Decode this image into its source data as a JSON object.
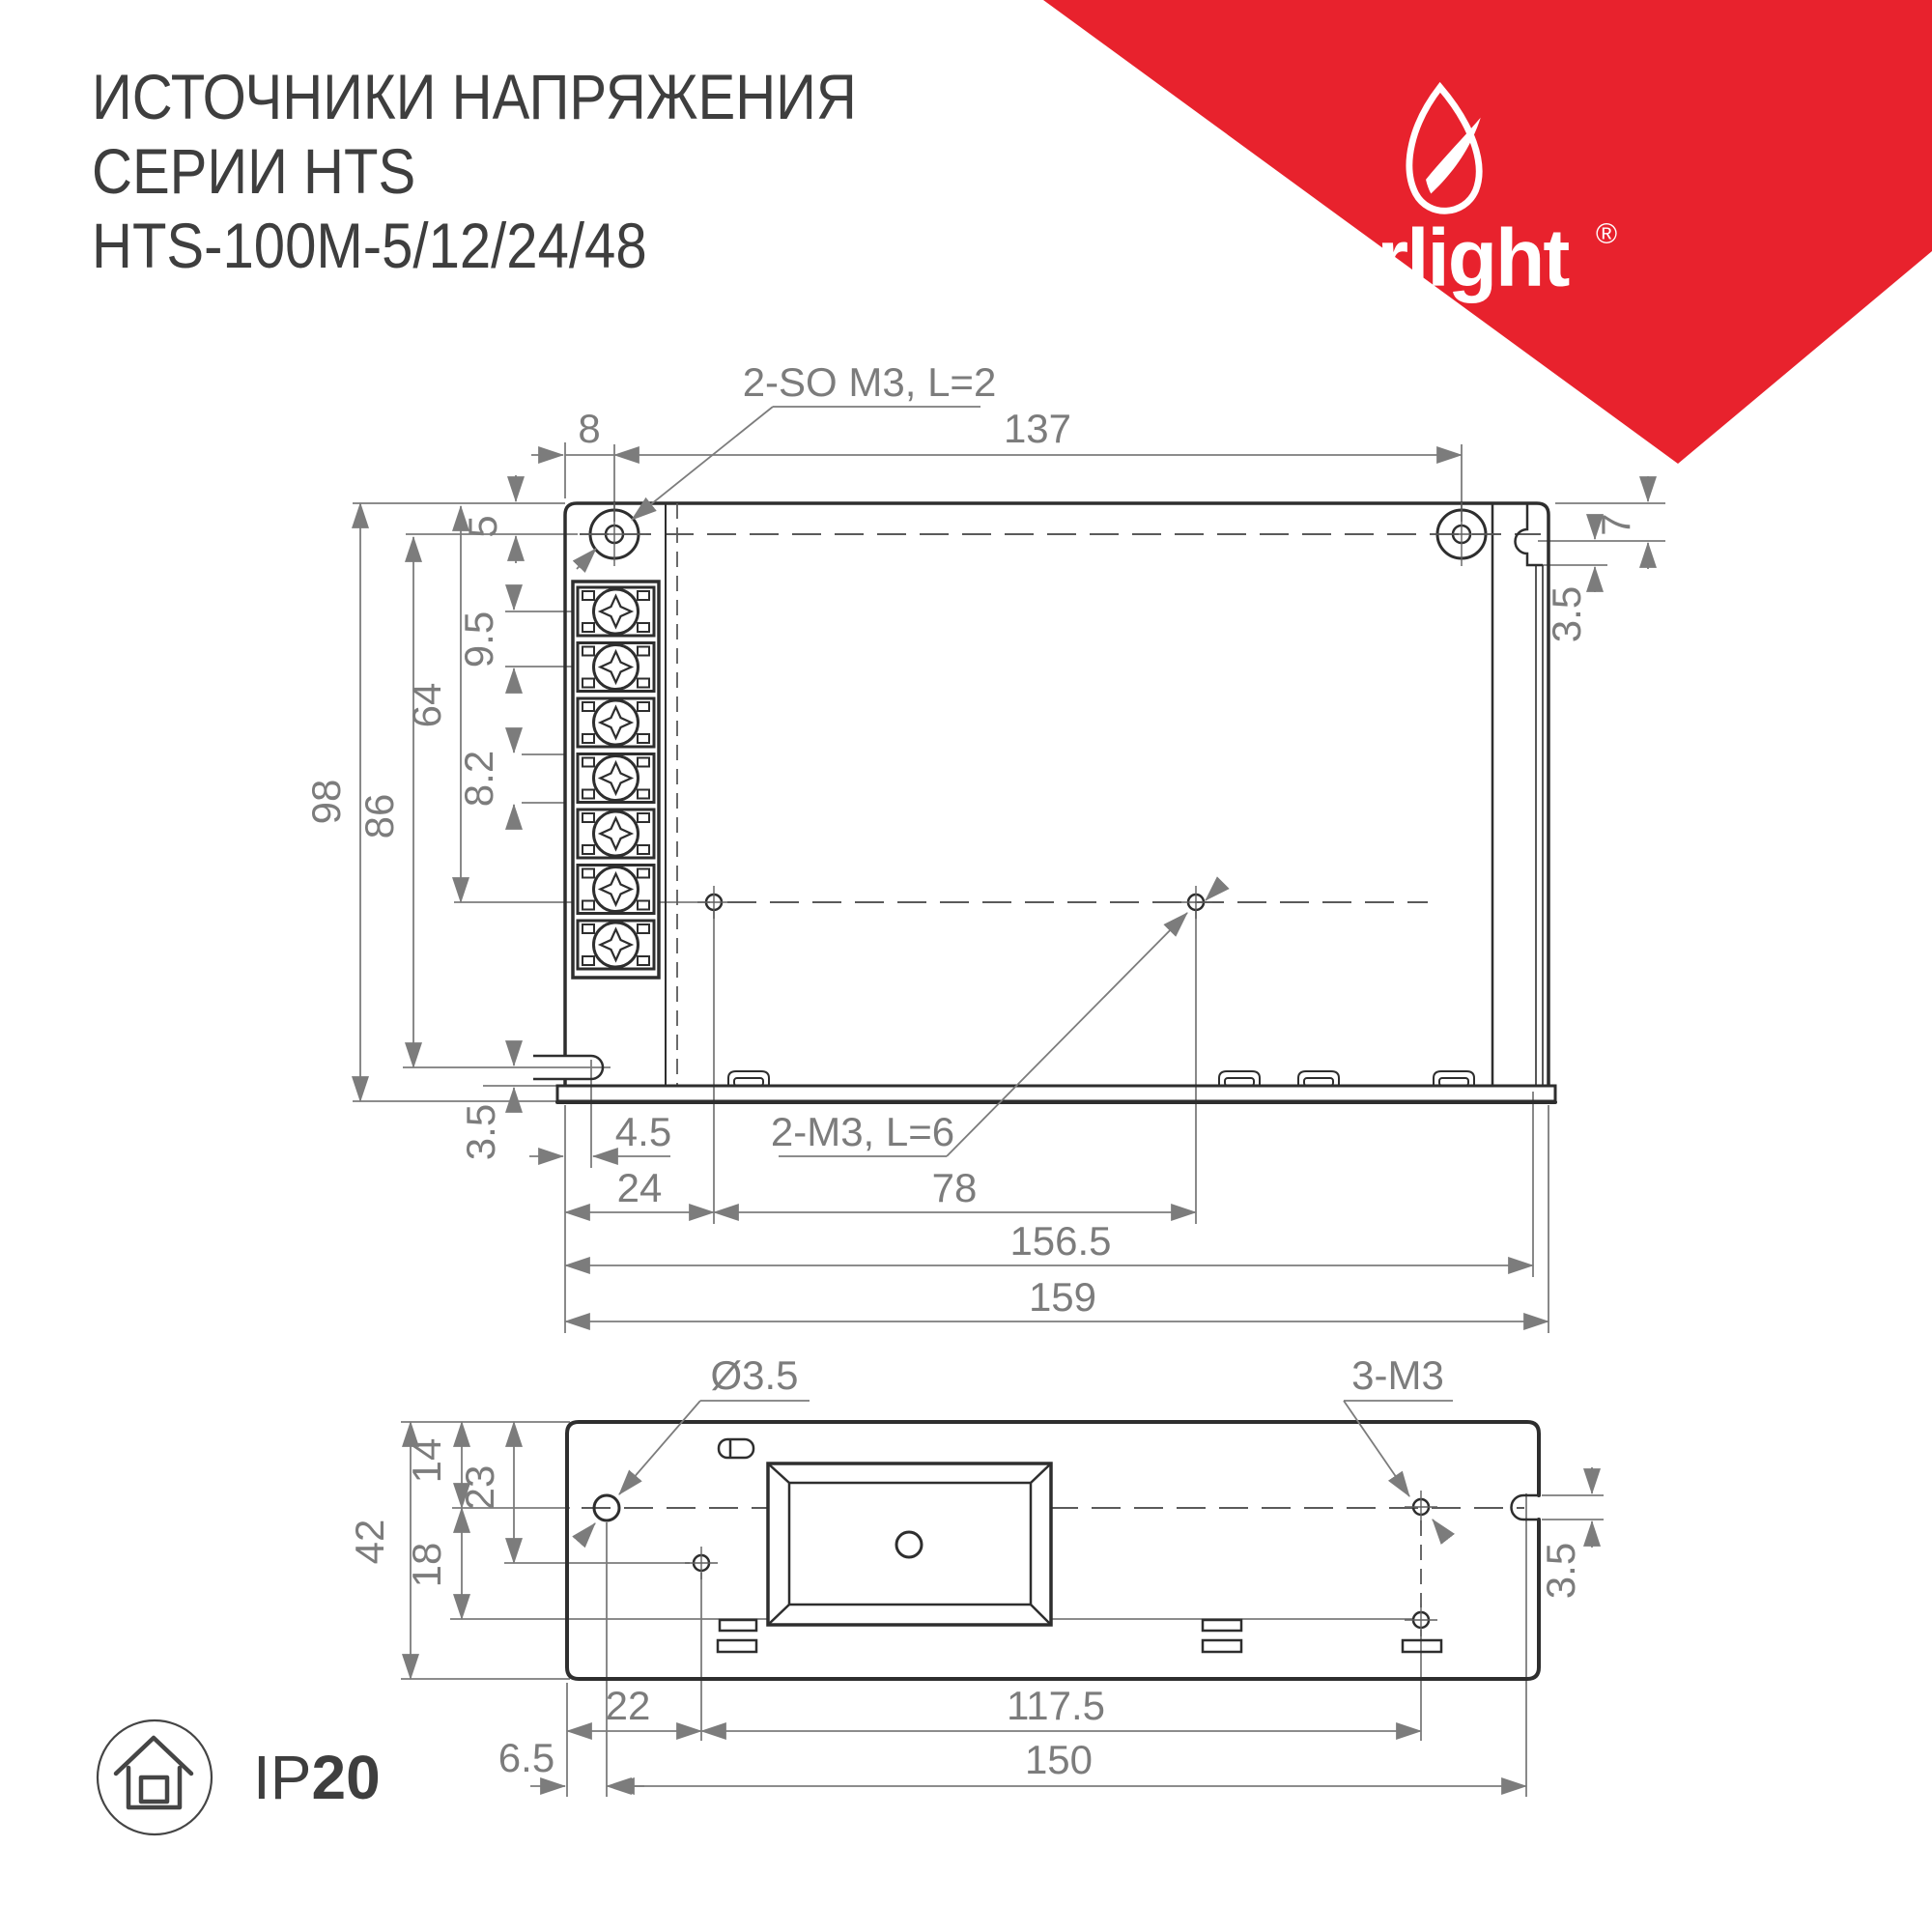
{
  "title": {
    "line1": "ИСТОЧНИКИ НАПРЯЖЕНИЯ",
    "line2": "СЕРИИ HTS",
    "line3": "HTS-100M-5/12/24/48"
  },
  "brand": {
    "name": "arlight",
    "registered": "®"
  },
  "colors": {
    "red": "#e8222d",
    "line_dark": "#2e2e2e",
    "line_dim": "#7c7c7c",
    "text": "#3e3e3e"
  },
  "icons": {
    "corner_logo": "arlight-leaf-swoosh-icon",
    "footer_badge": "indoor-house-icon"
  },
  "top_view": {
    "callout_screws": "2-SO M3, L=2",
    "callout_holes": "2-M3, L=6",
    "dims": {
      "screw_offset_x": "8",
      "screw_span_x": "137",
      "screw_offset_y": "5",
      "terminal_pitch_a": "9.5",
      "mount_span_y": "64",
      "terminal_pitch_b": "8.2",
      "height_outer": "98",
      "height_to_slot": "86",
      "slot_to_base": "3.5",
      "side_notch_y": "7",
      "side_notch_depth": "3.5",
      "slot_offset_x": "4.5",
      "hole_offset_x": "24",
      "hole_span_x": "78",
      "width_inner": "156.5",
      "width_outer": "159"
    }
  },
  "bottom_view": {
    "callout_hole": "Ø3.5",
    "callout_threads": "3-M3",
    "dims": {
      "height_outer": "42",
      "centerline_y": "14",
      "hole2_y": "23",
      "hole3_y": "18",
      "hole2_x": "22",
      "hole_span_x": "117.5",
      "hole1_x": "6.5",
      "mount_span_x": "150",
      "notch_depth": "3.5"
    }
  },
  "footer": {
    "ip_prefix": "IP",
    "ip_value": "20"
  }
}
